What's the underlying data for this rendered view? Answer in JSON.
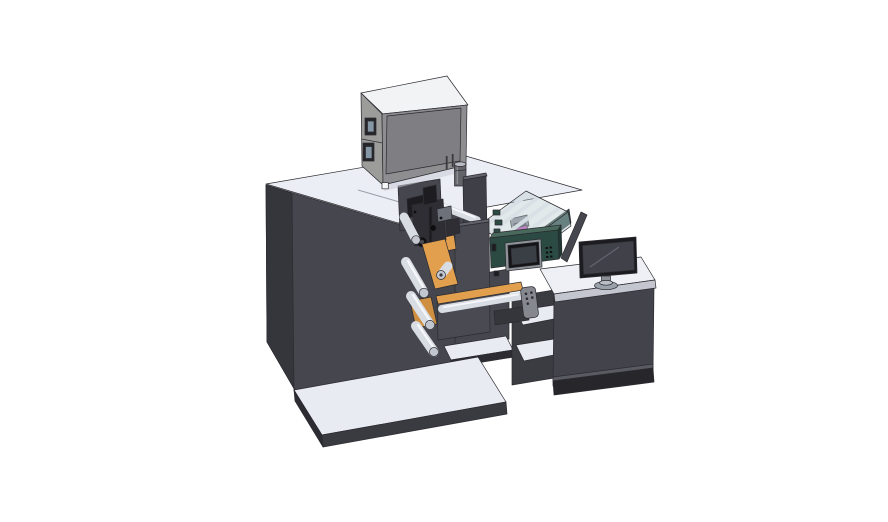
{
  "description": "3D CAD isometric render of a label printing and converting machine: dark press cabinet on a base plate, gray printer box on top, unwind rollers with orange web guides, black print-head assembly, clear safety guard with white slats and magenta head, teal HMI control box with small screen, and an operator console desk with a flat monitor",
  "palette": {
    "outline": "#2b2b30",
    "background": "#ffffff",
    "body_front": "#46464e",
    "body_left": "#35353c",
    "body_top": "#eceef5",
    "seam": "#9aa0aa",
    "base_top": "#e9ebf3",
    "base_front": "#3a3a41",
    "base_side": "#2c2c32",
    "shelf": "#e9ebf3",
    "wall": "#3f3f47",
    "box_top": "#f2f3f5",
    "box_front": "#8e8e90",
    "box_panel": "#7f7f83",
    "box_left": "#9c9c9b",
    "box_shadow": "#c9ccd4",
    "slot_frame": "#26262a",
    "slot_glass": "#8596a5",
    "vent": "#3a3a3e",
    "latch": "#f5f6f8",
    "cyl_body": "#63636a",
    "cyl_cap": "#b9bcc2",
    "cyl_hi": "#8b8b92",
    "glass_top": "rgba(186,203,208,0.42)",
    "glass_front": "rgba(168,188,194,0.48)",
    "glass_rim": "#2d4a43",
    "slat": "#eef1f5",
    "head_gray": "#878c93",
    "head_dark": "#5a5f66",
    "magenta": "#b750b2",
    "panel2": "#46464e",
    "connector": "#3b3b42",
    "desk_front": "#43434b",
    "desk_top": "#eef0f6",
    "desk_edge": "#c3c6ce",
    "plinth": "#26262b",
    "plinth_seam": "#5a5a63",
    "monitor_bezel": "#1c1c20",
    "monitor_screen": "#41414a",
    "monitor_line": "#65656f",
    "stand": "#8b9098",
    "stand_base": "#9ba1a9",
    "stand_hi": "#b9bec5",
    "teal_front": "#2b4a42",
    "teal_top": "#49695d",
    "teal_side": "#1e3831",
    "screen_frame": "#8d9399",
    "screen_bezel": "#141417",
    "screen_face": "#3a3f46",
    "btn": "#101012",
    "column": "#4a4a53",
    "column_top": "#62626b",
    "orange": "#e2a04f",
    "orange_dark": "#cf8f41",
    "roller": "#d8dce3",
    "roller_hi": "#f4f6f9",
    "roller_cap": "#c2c6ce",
    "roller_dark": "#3a3a40",
    "black_part": "#1d1d21",
    "black_part2": "#2e2e34",
    "motor_gray": "#6d727a",
    "knob": "#0e0e11",
    "pendant": "#85898f",
    "pendant_dot": "#2b2b30",
    "rail": "#35353c"
  }
}
